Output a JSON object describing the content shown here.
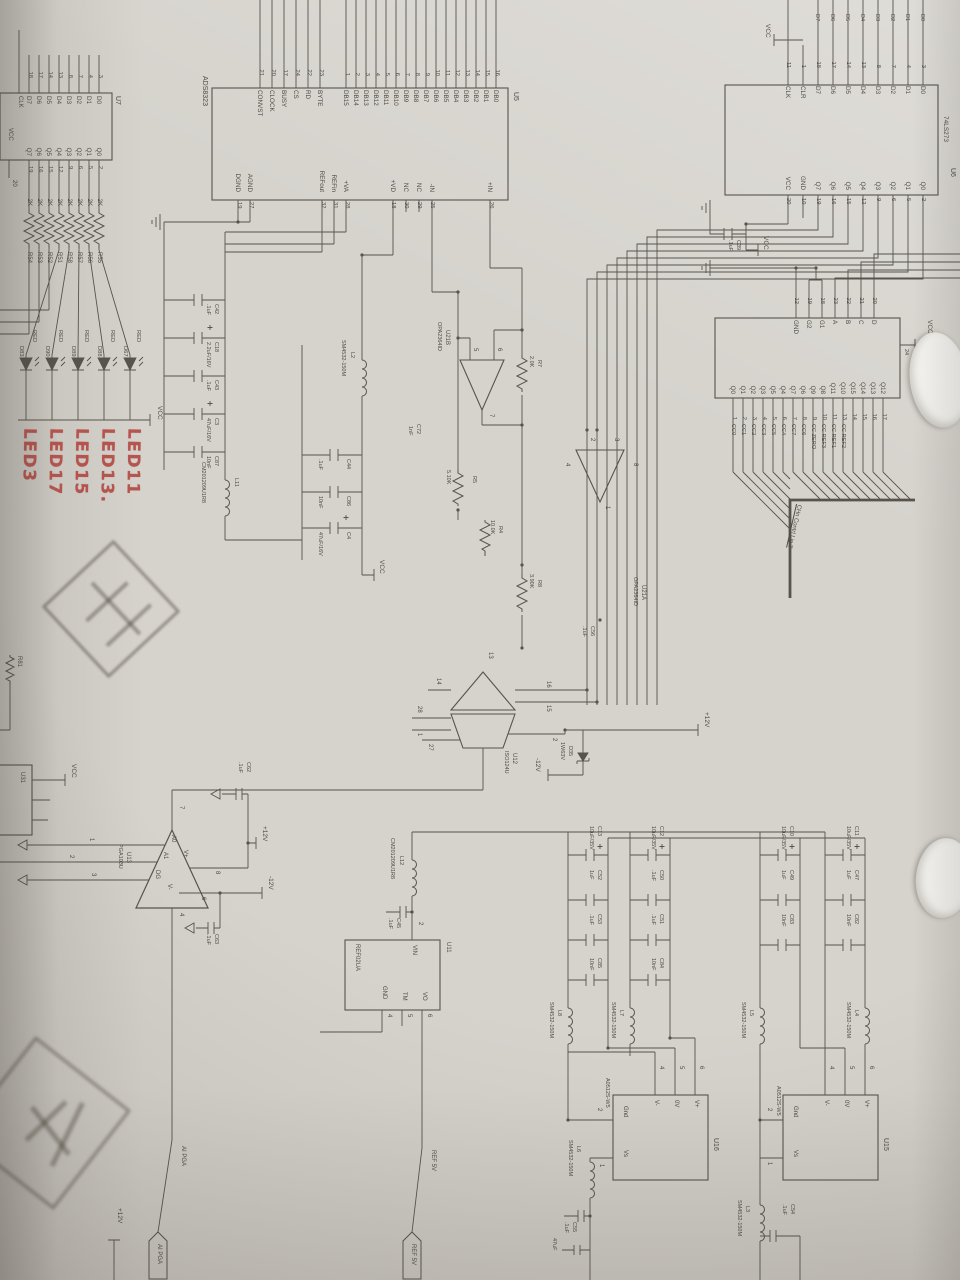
{
  "colors": {
    "ink": "#4f4b45",
    "red": "#b0453e",
    "paper": "#d6d3cd"
  },
  "u5": {
    "ref": "U5",
    "part": "ADS8323",
    "data_pins": [
      {
        "n": "16",
        "l": "DB0"
      },
      {
        "n": "15",
        "l": "DB1"
      },
      {
        "n": "14",
        "l": "DB2"
      },
      {
        "n": "13",
        "l": "DB3"
      },
      {
        "n": "12",
        "l": "DB4"
      },
      {
        "n": "11",
        "l": "DB5"
      },
      {
        "n": "10",
        "l": "DB6"
      },
      {
        "n": "9",
        "l": "DB7"
      },
      {
        "n": "8",
        "l": "DB8"
      },
      {
        "n": "7",
        "l": "DB9"
      },
      {
        "n": "6",
        "l": "DB10"
      },
      {
        "n": "5",
        "l": "DB11"
      },
      {
        "n": "4",
        "l": "DB12"
      },
      {
        "n": "3",
        "l": "DB13"
      },
      {
        "n": "2",
        "l": "DB14"
      },
      {
        "n": "1",
        "l": "DB15"
      }
    ],
    "ctrl_pins": [
      {
        "n": "23",
        "l": "BYTE"
      },
      {
        "n": "22",
        "l": "RD"
      },
      {
        "n": "24",
        "l": "CS"
      },
      {
        "n": "17",
        "l": "BUSY"
      },
      {
        "n": "20",
        "l": "CLOCK"
      },
      {
        "n": "21",
        "l": "CONVST"
      }
    ],
    "right_top": [
      {
        "n": "26",
        "l": "+IN"
      }
    ],
    "right_mid": [
      {
        "n": "25",
        "l": "-IN"
      },
      {
        "n": "29",
        "l": "NC"
      },
      {
        "n": "30",
        "l": "NC"
      },
      {
        "n": "18",
        "l": "+VD"
      }
    ],
    "right_ref": [
      {
        "n": "28",
        "l": "+VA"
      },
      {
        "n": "31",
        "l": "REFin"
      },
      {
        "n": "32",
        "l": "REFout"
      }
    ],
    "right_gnd": [
      {
        "n": "27",
        "l": "AGND"
      },
      {
        "n": "19",
        "l": "DGND"
      }
    ]
  },
  "u6": {
    "ref": "U6",
    "part": "74LS273",
    "nets": [
      "D0",
      "D1",
      "D2",
      "D3",
      "D4",
      "D5",
      "D6",
      "D7"
    ],
    "left": [
      {
        "n": "3",
        "l": "D0"
      },
      {
        "n": "4",
        "l": "D1"
      },
      {
        "n": "7",
        "l": "D2"
      },
      {
        "n": "8",
        "l": "D3"
      },
      {
        "n": "13",
        "l": "D4"
      },
      {
        "n": "14",
        "l": "D5"
      },
      {
        "n": "17",
        "l": "D6"
      },
      {
        "n": "18",
        "l": "D7"
      },
      {
        "n": "1",
        "l": "CLR"
      },
      {
        "n": "11",
        "l": "CLK"
      }
    ],
    "right": [
      {
        "n": "2",
        "l": "Q0"
      },
      {
        "n": "5",
        "l": "Q1"
      },
      {
        "n": "6",
        "l": "Q2"
      },
      {
        "n": "9",
        "l": "Q3"
      },
      {
        "n": "12",
        "l": "Q4"
      },
      {
        "n": "15",
        "l": "Q5"
      },
      {
        "n": "16",
        "l": "Q6"
      },
      {
        "n": "19",
        "l": "Q7"
      },
      {
        "n": "10",
        "l": "GND"
      },
      {
        "n": "20",
        "l": "VCC"
      }
    ]
  },
  "u7": {
    "ref": "U7",
    "clk": "CLK",
    "vcc": "VCC",
    "pin20": "20",
    "left": [
      {
        "n": "3",
        "l": "D0"
      },
      {
        "n": "4",
        "l": "D1"
      },
      {
        "n": "7",
        "l": "D2"
      },
      {
        "n": "8",
        "l": "D3"
      },
      {
        "n": "13",
        "l": "D4"
      },
      {
        "n": "14",
        "l": "D5"
      },
      {
        "n": "17",
        "l": "D6"
      },
      {
        "n": "18",
        "l": "D7"
      }
    ],
    "right": [
      {
        "n": "2",
        "l": "Q0"
      },
      {
        "n": "5",
        "l": "Q1"
      },
      {
        "n": "6",
        "l": "Q2"
      },
      {
        "n": "9",
        "l": "Q3"
      },
      {
        "n": "12",
        "l": "Q4"
      },
      {
        "n": "15",
        "l": "Q5"
      },
      {
        "n": "16",
        "l": "Q6"
      },
      {
        "n": "19",
        "l": "Q7"
      }
    ]
  },
  "u10": {
    "ref": "U10",
    "part": "74LS154",
    "vcc_pin": "24",
    "vcc": "VCC",
    "ctrl": [
      {
        "n": "20",
        "l": "D"
      },
      {
        "n": "21",
        "l": "C"
      },
      {
        "n": "22",
        "l": "B"
      },
      {
        "n": "23",
        "l": "A"
      },
      {
        "n": "18",
        "l": "G1"
      },
      {
        "n": "19",
        "l": "G2"
      },
      {
        "n": "12",
        "l": "GND"
      }
    ],
    "outs": [
      {
        "n": "17",
        "q": "Q12",
        "net": ""
      },
      {
        "n": "16",
        "q": "Q13",
        "net": ""
      },
      {
        "n": "15",
        "q": "Q14",
        "net": ""
      },
      {
        "n": "14",
        "q": "Q15",
        "net": ""
      },
      {
        "n": "13",
        "q": "Q10",
        "net": "CC REF2"
      },
      {
        "n": "11",
        "q": "Q11",
        "net": "CC REF1"
      },
      {
        "n": "10",
        "q": "Q8",
        "net": "CC REF3"
      },
      {
        "n": "9",
        "q": "Q9",
        "net": "CC ZERO"
      },
      {
        "n": "8",
        "q": "Q6",
        "net": "CC6"
      },
      {
        "n": "7",
        "q": "Q7",
        "net": "CC7"
      },
      {
        "n": "6",
        "q": "Q4",
        "net": "CC4"
      },
      {
        "n": "5",
        "q": "Q5",
        "net": "CC5"
      },
      {
        "n": "4",
        "q": "Q3",
        "net": "CC3"
      },
      {
        "n": "3",
        "q": "Q2",
        "net": "CC2"
      },
      {
        "n": "2",
        "q": "Q1",
        "net": "CC1"
      },
      {
        "n": "1",
        "q": "Q0",
        "net": "CC0"
      }
    ],
    "bus_label": "CHn Contrl Lig.T"
  },
  "res_array": [
    {
      "ref": "R55",
      "val": "2K"
    },
    {
      "ref": "R56",
      "val": "2K"
    },
    {
      "ref": "R57",
      "val": "2K"
    },
    {
      "ref": "R58",
      "val": "2K"
    },
    {
      "ref": "R51",
      "val": "2K"
    },
    {
      "ref": "R52",
      "val": "2K"
    },
    {
      "ref": "R53",
      "val": "2K"
    },
    {
      "ref": "R54",
      "val": "2K"
    }
  ],
  "leds": [
    {
      "c": "RED",
      "ref": "D67",
      "hand": "LED11"
    },
    {
      "c": "RED",
      "ref": "D88",
      "hand": "LED13."
    },
    {
      "c": "RED",
      "ref": "D89",
      "hand": "LED15"
    },
    {
      "c": "RED",
      "ref": "D90",
      "hand": "LED17"
    },
    {
      "c": "RED",
      "ref": "D83",
      "hand": "LED3"
    }
  ],
  "amps": {
    "u21a": {
      "ref": "U21A",
      "part": "OPA2364ID",
      "p_ip": "3",
      "p_im": "2",
      "p_out": "1",
      "p_vp": "8",
      "p_vm": "4"
    },
    "u21b": {
      "ref": "U21B",
      "part": "OPA2364ID",
      "p_ip": "6",
      "p_im": "5",
      "p_out": "7"
    }
  },
  "u12": {
    "ref": "U12",
    "part": "ISO124U",
    "p13": "13",
    "p14": "14",
    "p15": "15",
    "p16": "16",
    "p28": "28",
    "p1": "1",
    "p2": "2",
    "p27": "27"
  },
  "u13": {
    "ref": "U13",
    "part": "PGA103U",
    "a0": "A0",
    "a1": "A1",
    "dg": "DG",
    "vp": "V+",
    "vm": "V-",
    "n1": "1",
    "n2": "2",
    "n3": "3",
    "n4": "4",
    "n6": "6",
    "n7": "7",
    "n8": "8"
  },
  "u11": {
    "ref": "U11",
    "part": "REF02UA",
    "vin": "VIN",
    "vo": "VO",
    "tm": "TM",
    "gnd": "GND",
    "n2": "2",
    "n6": "6",
    "n5": "5",
    "n4": "4"
  },
  "u15": {
    "ref": "U15",
    "part": "A0512S-W5",
    "vp": "V+",
    "zv": "0V",
    "vm": "V-",
    "gnd": "Gnd",
    "vs": "Vs",
    "n6": "6",
    "n5": "5",
    "n4": "4",
    "n2": "2",
    "n1": "1"
  },
  "u16": {
    "ref": "U16",
    "part": "A0512S-W5",
    "vp": "V+",
    "zv": "0V",
    "vm": "V-",
    "gnd": "Gnd",
    "vs": "Vs",
    "n6": "6",
    "n5": "5",
    "n4": "4",
    "n2": "2",
    "n1": "1"
  },
  "parts": {
    "r7": {
      "ref": "R7",
      "val": "2.0K"
    },
    "r5": {
      "ref": "R5",
      "val": "5.10K"
    },
    "r4": {
      "ref": "R4",
      "val": "10.0K"
    },
    "r8": {
      "ref": "R8",
      "val": "3.90K"
    },
    "c72": {
      "ref": "C72",
      "val": "1nF"
    },
    "c56": {
      "ref": "C56",
      "val": ".1uF"
    },
    "c39": {
      "ref": "C39",
      "val": ".1uF"
    },
    "c42": {
      "ref": "C42",
      "val": ".1uF"
    },
    "c18": {
      "ref": "C18",
      "val": "2.2uF/16V"
    },
    "c43": {
      "ref": "C43",
      "val": ".1uF"
    },
    "c3": {
      "ref": "C3",
      "val": "47uF/16V"
    },
    "c87": {
      "ref": "C87",
      "val": "10nF"
    },
    "c44": {
      "ref": "C44",
      "val": ".1uF"
    },
    "c86": {
      "ref": "C86",
      "val": "10nF"
    },
    "c4": {
      "ref": "C4",
      "val": "47uF/16V"
    },
    "c62": {
      "ref": "C62",
      "val": ".1uF"
    },
    "c63": {
      "ref": "C63",
      "val": ".1uF"
    },
    "c45": {
      "ref": "C45",
      "val": ".1uF"
    },
    "c55": {
      "ref": "C55",
      "val": ".1uF"
    },
    "c54": {
      "ref": "C54",
      "val": ".1uF"
    },
    "c47partial": "47uF",
    "d35": {
      "ref": "D35",
      "val": "1W63V"
    },
    "l2": {
      "ref": "L2",
      "val": "SM4532-150M"
    },
    "l3": {
      "ref": "L3",
      "val": "SM4532-150M"
    },
    "l4": {
      "ref": "L4",
      "val": "SM4532-150M"
    },
    "l5": {
      "ref": "L5",
      "val": "SM4532-150M"
    },
    "l6": {
      "ref": "L6",
      "val": "SM4532-150M"
    },
    "l7": {
      "ref": "L7",
      "val": "SM4532-150M"
    },
    "l8": {
      "ref": "L8",
      "val": "SM4532-150M"
    },
    "l11": {
      "ref": "L11",
      "val": "CM201209U1R8"
    },
    "l12": {
      "ref": "L12",
      "val": "CM201209U1R8"
    },
    "r81": "R81",
    "u31": "U31"
  },
  "bank1": [
    {
      "ref": "C13",
      "val": "10uF/35V"
    },
    {
      "ref": "C52",
      "val": "1uF"
    },
    {
      "ref": "C53",
      "val": ".1uF"
    },
    {
      "ref": "C85",
      "val": "10nF"
    }
  ],
  "bank2": [
    {
      "ref": "C12",
      "val": "10uF/35V"
    },
    {
      "ref": "C50",
      "val": ".1uF"
    },
    {
      "ref": "C51",
      "val": ".1uF"
    },
    {
      "ref": "C84",
      "val": "10nF"
    }
  ],
  "bank3": [
    {
      "ref": "C10",
      "val": "10uF/35V"
    },
    {
      "ref": "C49",
      "val": "1uF"
    },
    {
      "ref": "C83",
      "val": "10nF"
    }
  ],
  "bank4": [
    {
      "ref": "C11",
      "val": "10uF/35V"
    },
    {
      "ref": "C47",
      "val": "1uF"
    },
    {
      "ref": "C82",
      "val": "10nF"
    }
  ],
  "flags": {
    "vcc": "VCC",
    "p12": "+12V",
    "m12": "-12V",
    "ref5": "REF 5V",
    "aipga": "AI PGA"
  }
}
